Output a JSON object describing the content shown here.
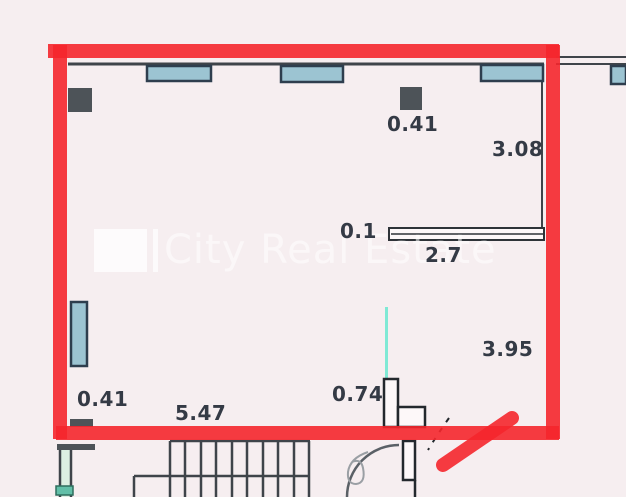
{
  "plan": {
    "watermark": {
      "text": "City Real Estate"
    },
    "dimensions": {
      "radiator_top": "0.41",
      "right_wall_upper": "3.08",
      "partition_thickness": "0.1",
      "partition_length": "2.7",
      "right_wall_lower": "3.95",
      "door_opening": "0.74",
      "radiator_bottom": "0.41",
      "bottom_wall": "5.47"
    },
    "colors": {
      "background": "#f6eef0",
      "outline": "#f5262c",
      "window_fill": "#9cc4d2",
      "window_border": "#2e3e4e",
      "wall": "#3f444a",
      "column_fill": "#4d5358",
      "teal_marker": "#7fe9d5",
      "green_marker": "#62bfa8",
      "label_text": "#343a45",
      "watermark": "#ffffff"
    }
  }
}
